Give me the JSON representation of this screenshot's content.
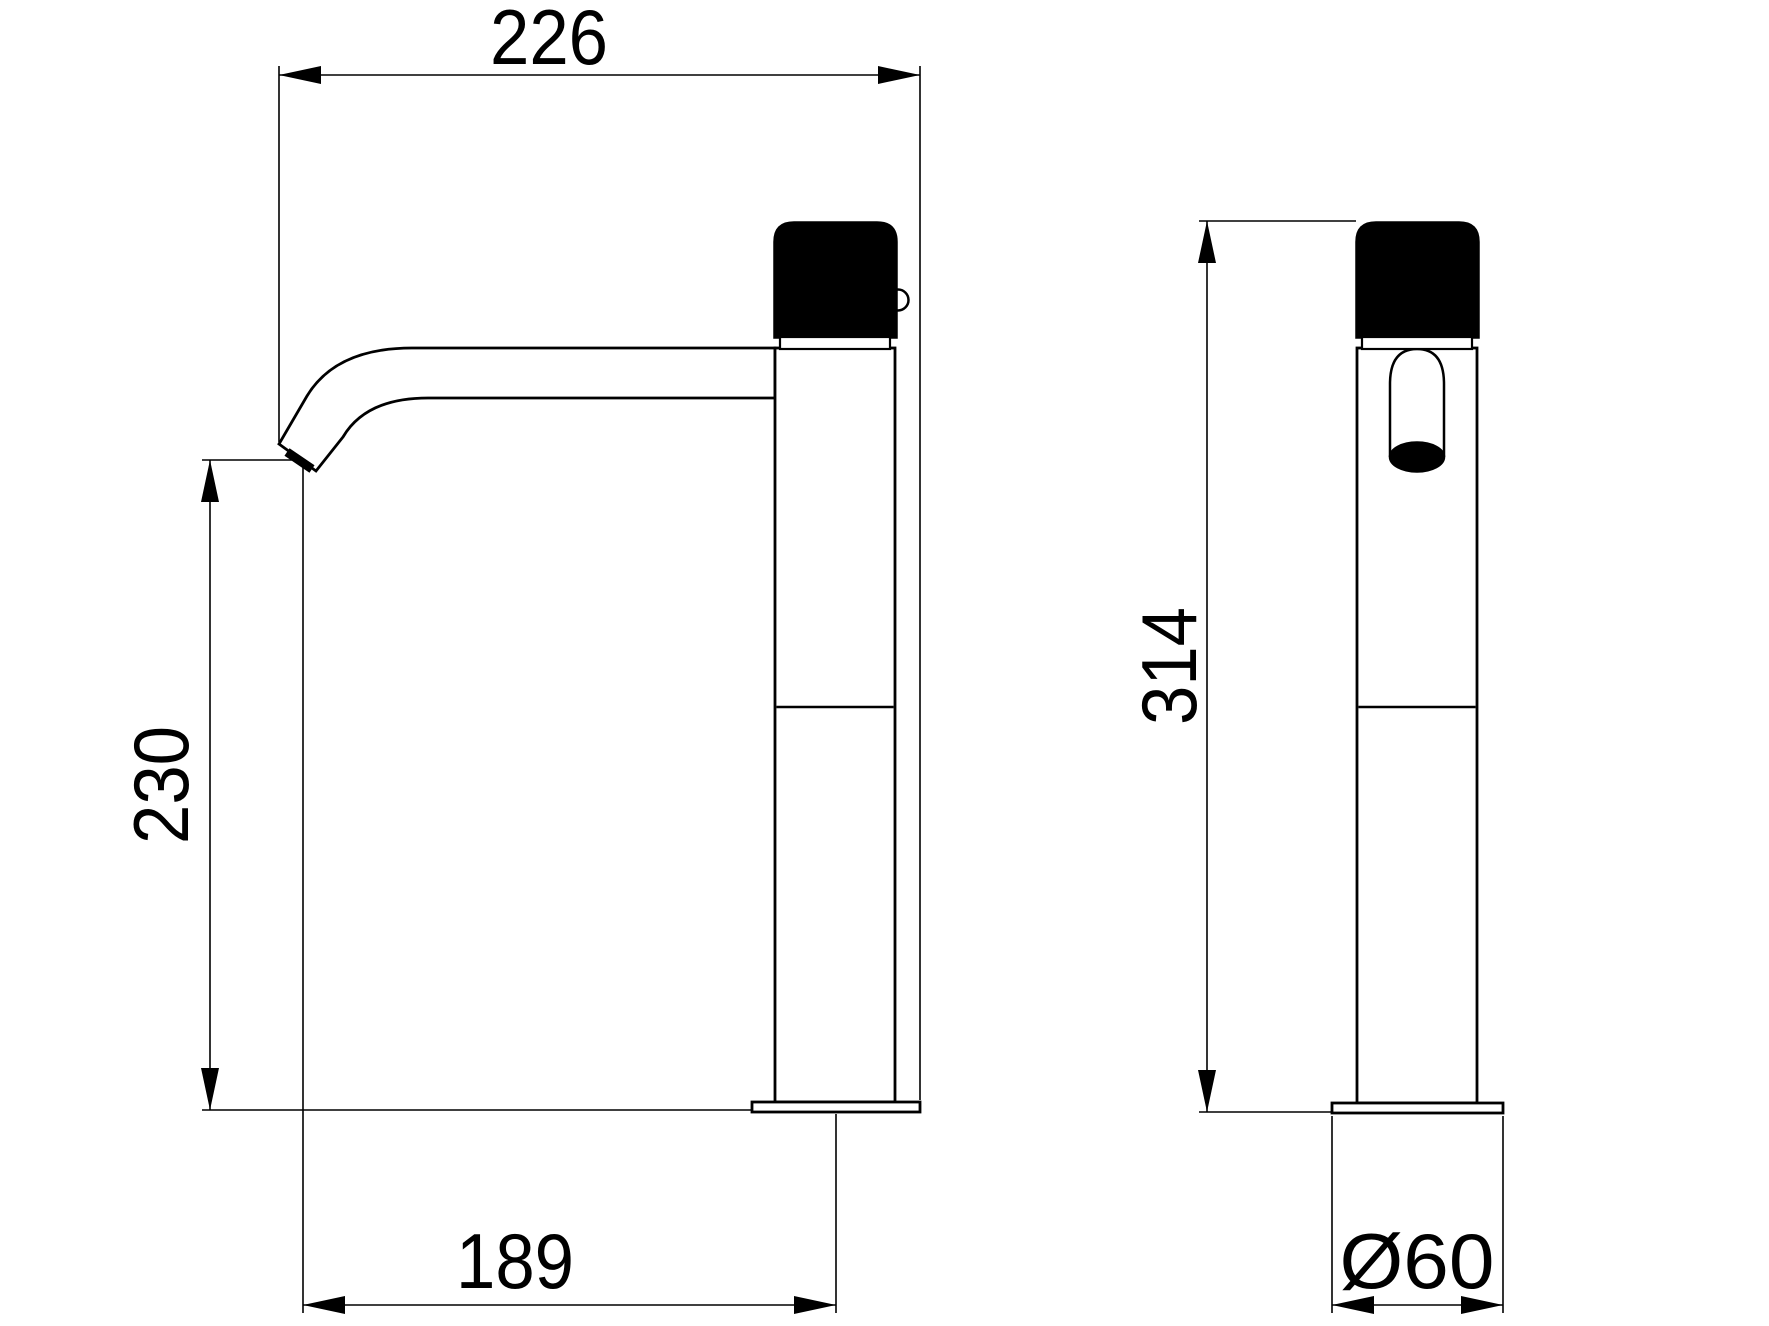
{
  "dimensions": {
    "overall_reach": "226",
    "spout_height": "230",
    "spout_reach": "189",
    "overall_height": "314",
    "base_diameter": "Ø60"
  }
}
